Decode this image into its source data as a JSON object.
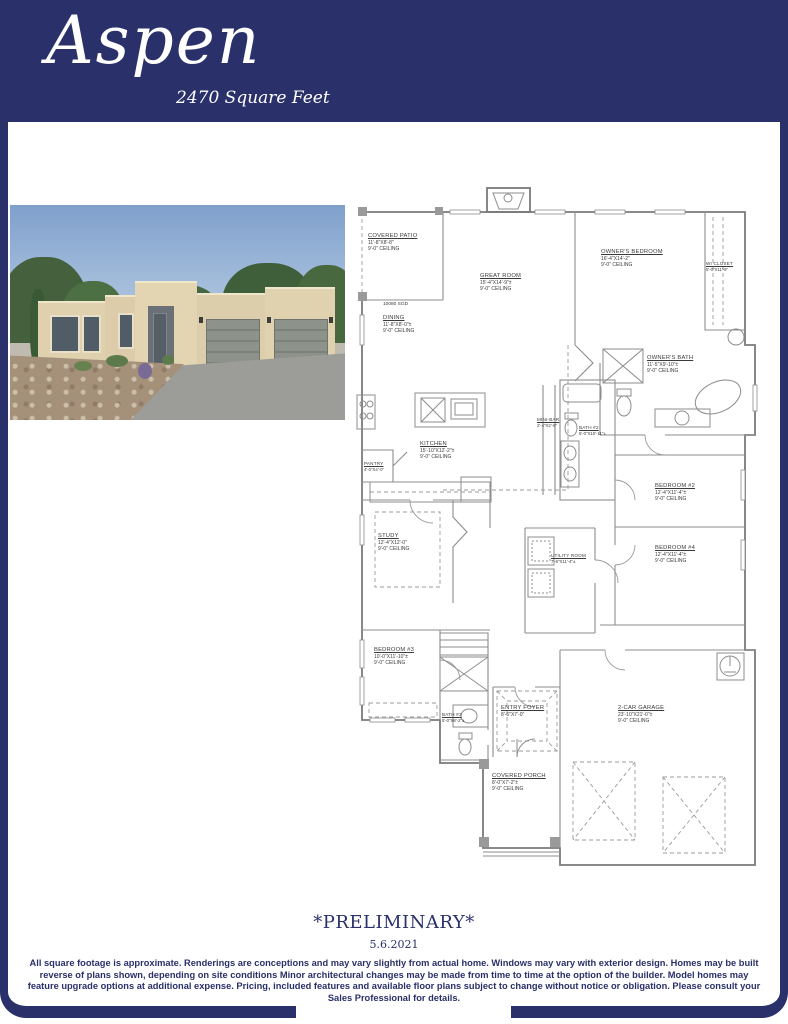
{
  "header": {
    "title": "Aspen",
    "subtitle": "2470  Square Feet"
  },
  "colors": {
    "navy": "#2a3069"
  },
  "floorplan": {
    "annotations": {
      "sgd": "10080 SGD"
    },
    "rooms": [
      {
        "name": "COVERED PATIO",
        "dims": "11'-8\"X8'-8\"",
        "ceiling": "9'-0\" CEILING"
      },
      {
        "name": "GREAT ROOM",
        "dims": "15'-4\"X14'-9\"±",
        "ceiling": "9'-0\" CEILING"
      },
      {
        "name": "OWNER'S BEDROOM",
        "dims": "16'-4\"X14'-2\"",
        "ceiling": "9'-0\" CEILING"
      },
      {
        "name": "WI CLOSET",
        "dims": "5'-0\"X11'-9\""
      },
      {
        "name": "OWNER'S BATH",
        "dims": "11'-5\"X9'-10\"±",
        "ceiling": "9'-0\" CEILING"
      },
      {
        "name": "DINING",
        "dims": "11'-8\"X8'-0\"±",
        "ceiling": "9'-0\" CEILING"
      },
      {
        "name": "KITCHEN",
        "dims": "15'-10\"X12'-2\"±",
        "ceiling": "9'-0\" CEILING"
      },
      {
        "name": "PANTRY",
        "dims": "4'-0\"X4'-0\""
      },
      {
        "name": "MINI-BAR",
        "dims": "2'-4\"X2'-8\""
      },
      {
        "name": "BATH #2",
        "dims": "5'-0\"X10'-11\"±"
      },
      {
        "name": "BEDROOM #2",
        "dims": "12'-4\"X11'-4\"±",
        "ceiling": "9'-0\" CEILING"
      },
      {
        "name": "BEDROOM #4",
        "dims": "12'-4\"X11'-4\"±",
        "ceiling": "9'-0\" CEILING"
      },
      {
        "name": "STUDY",
        "dims": "12'-4\"X12'-0\"",
        "ceiling": "9'-0\" CEILING"
      },
      {
        "name": "UTILITY ROOM",
        "dims": "7'-6\"X11'-4\"±"
      },
      {
        "name": "BEDROOM #3",
        "dims": "10'-0\"X11'-10\"±",
        "ceiling": "9'-0\" CEILING"
      },
      {
        "name": "BATH #3",
        "dims": "5'-0\"X8'-2\"±"
      },
      {
        "name": "ENTRY FOYER",
        "dims": "8'-6\"X7'-0\""
      },
      {
        "name": "COVERED PORCH",
        "dims": "8'-0\"X7'-2\"±",
        "ceiling": "9'-0\" CEILING"
      },
      {
        "name": "2-CAR GARAGE",
        "dims": "23'-10\"X21'-0\"±",
        "ceiling": "9'-0\" CEILING"
      }
    ]
  },
  "footer": {
    "preliminary": "*PRELIMINARY*",
    "date": "5.6.2021",
    "disclaimer": "All square footage is approximate. Renderings are conceptions and may vary slightly from actual home. Windows may vary with exterior design. Homes may be built reverse of plans shown, depending on site conditions Minor architectural changes may be made from time to time at the option of the builder. Model homes may feature upgrade options at additional expense. Pricing, included features and available floor plans subject to change without notice or obligation. Please consult your Sales Professional for details."
  }
}
